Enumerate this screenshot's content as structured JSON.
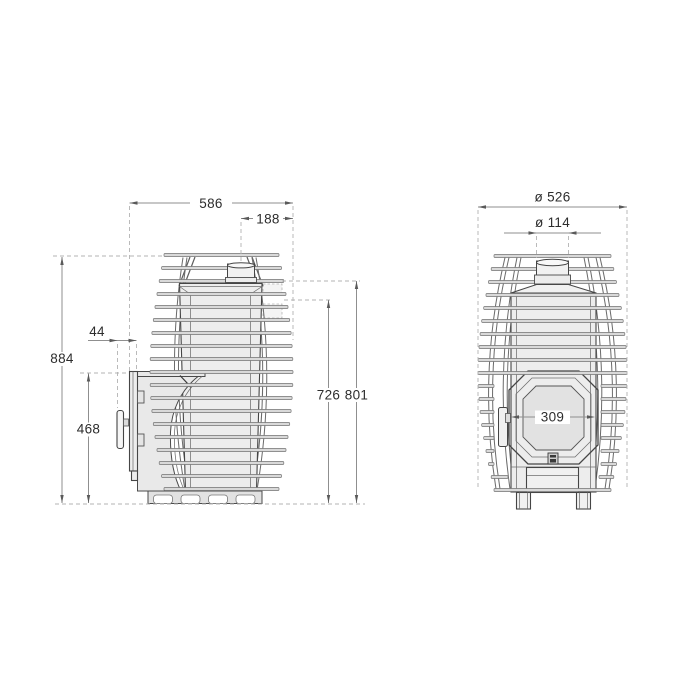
{
  "drawing": {
    "colors": {
      "background": "#ffffff",
      "outline": "#454545",
      "rail_fill": "#d9d9d9",
      "body_fill": "#ededed",
      "dimension_line": "#8f8f8f",
      "extension_dash": "#b3b3b3",
      "label_text": "#2d2d2d"
    },
    "side_view": {
      "dimensions": {
        "overall_depth": "586",
        "chimney_axis_to_back": "188",
        "handle_offset": "44",
        "overall_height": "884",
        "firebox_front_height": "468",
        "cage_top_height": "726",
        "body_top_height": "801"
      }
    },
    "front_view": {
      "dimensions": {
        "overall_diameter": "ø 526",
        "chimney_diameter": "ø 114",
        "door_frame_width": "309"
      }
    }
  }
}
